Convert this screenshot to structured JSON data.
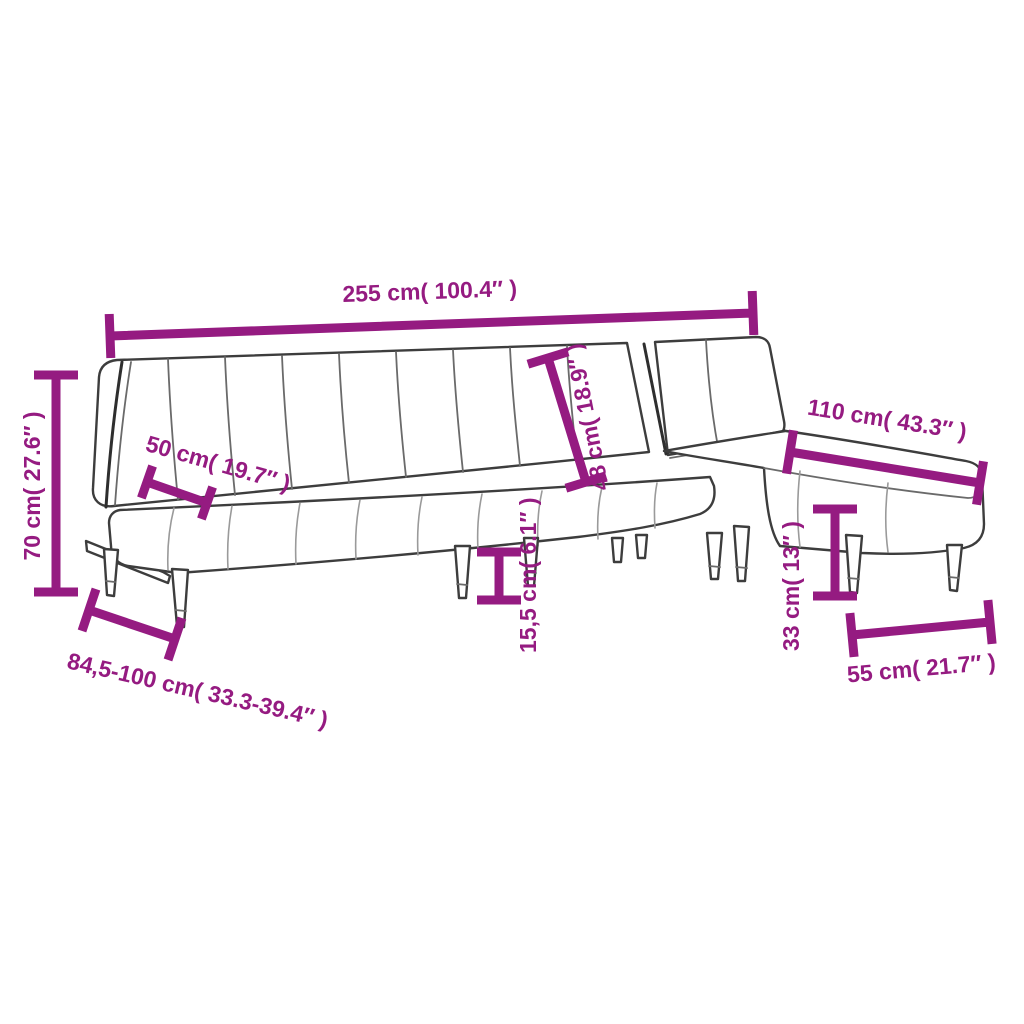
{
  "diagram": {
    "title": "L-shaped sofa bed dimension diagram",
    "product": "l-shaped-sofa-bed",
    "style": {
      "accent_color": "#951B81",
      "line_color": "#3D3D3D",
      "background_color": "#FFFFFF"
    },
    "dimensions": [
      {
        "id": "overall-length",
        "label": "255 cm( 100.4″ )"
      },
      {
        "id": "overall-height",
        "label": "70 cm( 27.6″ )"
      },
      {
        "id": "seat-depth",
        "label": "50 cm( 19.7″ )"
      },
      {
        "id": "backrest-height",
        "label": "48 cm( 18.9″ )"
      },
      {
        "id": "ground-clearance",
        "label": "15,5 cm( 6.1″ )"
      },
      {
        "id": "chaise-length",
        "label": "110 cm( 43.3″ )"
      },
      {
        "id": "seat-height",
        "label": "33 cm( 13″ )"
      },
      {
        "id": "chaise-width",
        "label": "55 cm( 21.7″ )"
      },
      {
        "id": "floor-depth-range",
        "label": "84,5-100 cm( 33.3-39.4″ )"
      }
    ]
  }
}
